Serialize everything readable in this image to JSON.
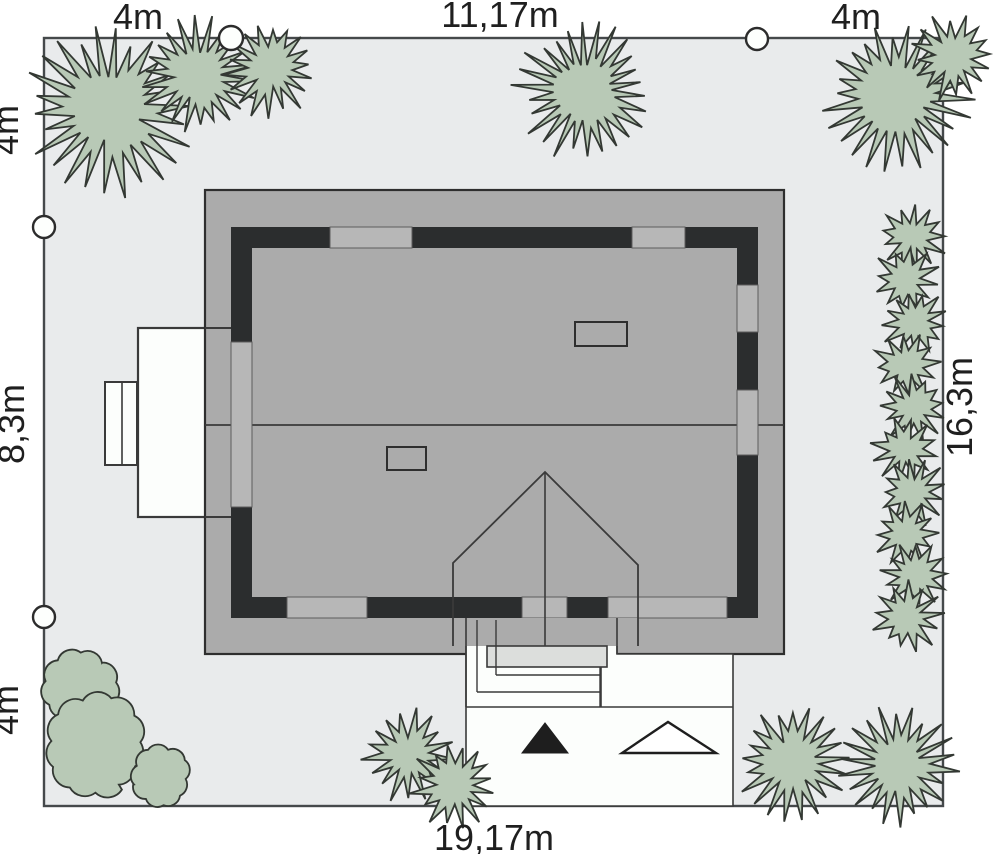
{
  "title": "house-site-plan",
  "colors": {
    "plot_fill": "#e9ebec",
    "plot_stroke": "#45494b",
    "roof_fill": "#ababab",
    "roof_stroke": "#2e2e2e",
    "wall_dark": "#2b2d2e",
    "window_fill": "#b7b7b7",
    "window_stroke": "#5c5c5c",
    "white_fill": "#fcfefc",
    "slab_fill": "#dcdedc",
    "line": "#3a3a3a",
    "tree_fill": "#b8c9b6",
    "tree_stroke": "#333833",
    "marker_fill": "#fdfffd",
    "text": "#1f1f1f"
  },
  "plot": {
    "x": 44,
    "y": 38,
    "w": 899,
    "h": 768
  },
  "boundary_markers": [
    {
      "cx": 231,
      "cy": 38,
      "r": 12
    },
    {
      "cx": 757,
      "cy": 39,
      "r": 11
    },
    {
      "cx": 44,
      "cy": 227,
      "r": 11
    },
    {
      "cx": 44,
      "cy": 617,
      "r": 11
    }
  ],
  "dimensions": [
    {
      "text": "4m",
      "x": 138,
      "y": 29,
      "rotate": false
    },
    {
      "text": "11,17m",
      "x": 500,
      "y": 27,
      "rotate": false
    },
    {
      "text": "4m",
      "x": 856,
      "y": 29,
      "rotate": false
    },
    {
      "text": "4m",
      "x": 18,
      "y": 130,
      "rotate": true
    },
    {
      "text": "8,3m",
      "x": 24,
      "y": 424,
      "rotate": true
    },
    {
      "text": "4m",
      "x": 18,
      "y": 710,
      "rotate": true
    },
    {
      "text": "16,3m",
      "x": 972,
      "y": 407,
      "rotate": true
    },
    {
      "text": "19,17m",
      "x": 494,
      "y": 850,
      "rotate": false
    }
  ],
  "house": {
    "roof": {
      "x": 205,
      "y": 190,
      "w": 579,
      "h": 464
    },
    "ridge_y": 425,
    "wall": {
      "x": 231,
      "y": 227,
      "w": 527,
      "h": 391,
      "t": 21
    },
    "wall_windows": {
      "top": [
        [
          330,
          412
        ],
        [
          632,
          685
        ]
      ],
      "bottom": [
        [
          287,
          367
        ],
        [
          522,
          567
        ],
        [
          608,
          727
        ]
      ],
      "left": [
        [
          342,
          507
        ]
      ],
      "right": [
        [
          285,
          332
        ],
        [
          390,
          455
        ]
      ]
    },
    "chimneys": [
      {
        "x": 575,
        "y": 322,
        "w": 52,
        "h": 24
      },
      {
        "x": 387,
        "y": 447,
        "w": 39,
        "h": 23
      }
    ],
    "annex": {
      "main": {
        "x": 138,
        "y": 328,
        "w": 93,
        "h": 189
      },
      "side": {
        "x": 105,
        "y": 382,
        "w": 32,
        "h": 83
      },
      "side_divider_x": 122,
      "ext_lines": [
        [
          205,
          328,
          231,
          328
        ],
        [
          205,
          517,
          231,
          517
        ]
      ]
    },
    "porch": {
      "outline": [
        [
          453,
          646
        ],
        [
          453,
          563
        ],
        [
          545,
          472
        ],
        [
          638,
          565
        ],
        [
          638,
          646
        ]
      ],
      "insert": {
        "x": 453,
        "y": 618,
        "w": 185,
        "h": 28
      },
      "ridge": [
        545,
        472,
        545,
        667
      ]
    },
    "path": {
      "polygon": [
        [
          466,
          620
        ],
        [
          617,
          620
        ],
        [
          617,
          654
        ],
        [
          733,
          654
        ],
        [
          733,
          806
        ],
        [
          466,
          806
        ]
      ],
      "lines": [
        [
          466,
          618,
          466,
          707
        ],
        [
          617,
          618,
          617,
          654
        ],
        [
          601,
          654,
          601,
          707
        ],
        [
          466,
          707,
          733,
          707
        ]
      ]
    },
    "steps": {
      "slab": {
        "x": 487,
        "y": 646,
        "w": 120,
        "h": 21
      },
      "lines": [
        [
          477,
          620,
          477,
          692
        ],
        [
          496,
          620,
          496,
          675
        ],
        [
          600,
          667,
          600,
          707
        ],
        [
          496,
          675,
          600,
          675
        ],
        [
          477,
          692,
          600,
          692
        ]
      ]
    }
  },
  "entrance_markers": {
    "black_triangle": [
      [
        522,
        753
      ],
      [
        568,
        753
      ],
      [
        545,
        723
      ]
    ],
    "white_triangle": [
      [
        622,
        753
      ],
      [
        716,
        753
      ],
      [
        668,
        722
      ]
    ]
  },
  "trees": {
    "conifers": [
      {
        "cx": 110,
        "cy": 110,
        "r": 80
      },
      {
        "cx": 198,
        "cy": 76,
        "r": 56
      },
      {
        "cx": 271,
        "cy": 69,
        "r": 46
      },
      {
        "cx": 585,
        "cy": 91,
        "r": 67
      },
      {
        "cx": 897,
        "cy": 96,
        "r": 71
      },
      {
        "cx": 953,
        "cy": 57,
        "r": 42
      },
      {
        "cx": 408,
        "cy": 755,
        "r": 45
      },
      {
        "cx": 455,
        "cy": 785,
        "r": 42
      },
      {
        "cx": 793,
        "cy": 762,
        "r": 55
      },
      {
        "cx": 898,
        "cy": 765,
        "r": 57
      }
    ],
    "hedge_bushes": [
      {
        "cx": 912,
        "cy": 237,
        "r": 33
      },
      {
        "cx": 906,
        "cy": 280,
        "r": 32
      },
      {
        "cx": 915,
        "cy": 322,
        "r": 33
      },
      {
        "cx": 906,
        "cy": 365,
        "r": 32
      },
      {
        "cx": 913,
        "cy": 408,
        "r": 33
      },
      {
        "cx": 905,
        "cy": 450,
        "r": 32
      },
      {
        "cx": 913,
        "cy": 492,
        "r": 33
      },
      {
        "cx": 906,
        "cy": 534,
        "r": 32
      },
      {
        "cx": 914,
        "cy": 576,
        "r": 33
      },
      {
        "cx": 908,
        "cy": 617,
        "r": 34
      }
    ],
    "deciduous": [
      {
        "cx": 80,
        "cy": 688,
        "r": 34
      },
      {
        "cx": 96,
        "cy": 748,
        "r": 49
      },
      {
        "cx": 161,
        "cy": 777,
        "r": 28
      }
    ]
  }
}
